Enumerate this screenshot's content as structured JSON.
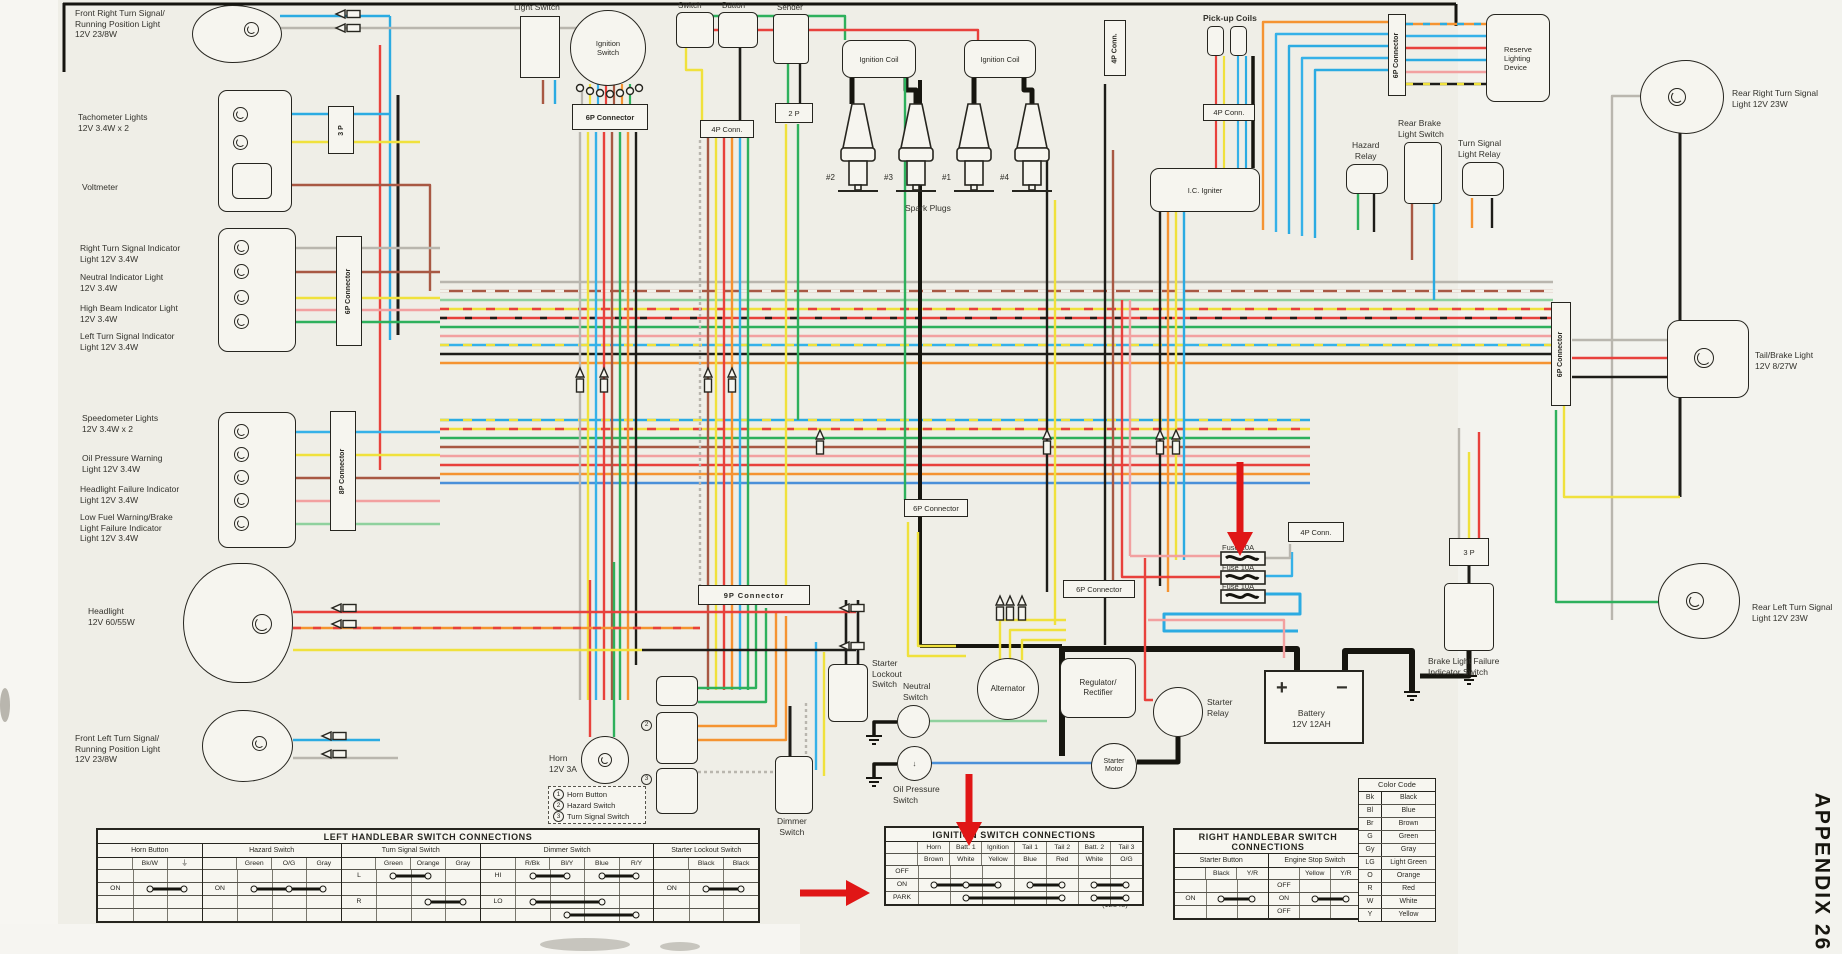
{
  "colors": {
    "red": "#e8413c",
    "blue": "#2babe2",
    "lightblue": "#35b1e8",
    "darkblue": "#4a90d9",
    "yellow": "#f0e13c",
    "green": "#2eb05c",
    "lightgreen": "#8fd19e",
    "orange": "#f59331",
    "brown": "#a85843",
    "gray": "#b9b6ae",
    "pink": "#f2a0a0",
    "black": "#1d1c18",
    "annotation": "#e01616",
    "paper": "#efeee7"
  },
  "labels": {
    "front_right_signal": "Front Right Turn Signal/\nRunning Position Light\n12V 23/8W",
    "tach": "Tachometer Lights\n12V 3.4W x 2",
    "voltmeter": "Voltmeter",
    "right_turn_ind": "Right Turn Signal Indicator\nLight 12V 3.4W",
    "neutral_ind": "Neutral Indicator Light\n12V 3.4W",
    "high_beam_ind": "High Beam Indicator Light\n12V 3.4W",
    "left_turn_ind": "Left Turn Signal Indicator\nLight 12V 3.4W",
    "speedo": "Speedometer Lights\n12V 3.4W x 2",
    "oil_warn": "Oil Pressure Warning\nLight 12V 3.4W",
    "hl_fail": "Headlight Failure Indicator\nLight 12V 3.4W",
    "low_fuel": "Low Fuel Warning/Brake\nLight Failure Indicator\nLight 12V 3.4W",
    "headlight": "Headlight\n12V 60/55W",
    "front_left_signal": "Front Left Turn Signal/\nRunning Position Light\n12V 23/8W",
    "horn": "Horn\n12V 3A",
    "light_switch": "Light Switch",
    "ignition_switch": "Ignition\nSwitch",
    "switch_top": "Switch",
    "button_top": "Button",
    "sender_top": "Sender",
    "conn_6p": "6P Connector",
    "conn_8p": "8P Connector",
    "conn_9p": "9P Connector",
    "conn_4p": "4P Conn.",
    "conn_2p": "2 P",
    "conn_3p": "3 P",
    "ignition_coil": "Ignition Coil",
    "spark_plugs": "Spark Plugs",
    "plug_2": "#2",
    "plug_3": "#3",
    "plug_1": "#1",
    "plug_4": "#4",
    "pickup_coils": "Pick-up Coils",
    "ic_igniter": "I.C. Igniter",
    "hazard_relay": "Hazard\nRelay",
    "rear_brake_switch": "Rear Brake\nLight Switch",
    "ts_relay": "Turn Signal\nLight Relay",
    "reserve": "Reserve\nLighting\nDevice",
    "rear_right_signal": "Rear Right Turn Signal\nLight 12V 23W",
    "tail_brake": "Tail/Brake Light\n12V 8/27W",
    "rear_left_signal": "Rear Left Turn Signal\nLight 12V 23W",
    "brake_fail_switch": "Brake Light Failure\nIndicator Switch",
    "fuse_20": "Fuse 20A",
    "fuse_10a": "Fuse 10A",
    "fuse_10b": "Fuse 10A",
    "starter_lockout": "Starter\nLockout\nSwitch",
    "neutral_switch": "Neutral\nSwitch",
    "oil_switch": "Oil Pressure\nSwitch",
    "alternator": "Alternator",
    "regulator": "Regulator/\nRectifier",
    "starter_relay": "Starter\nRelay",
    "starter_motor": "Starter\nMotor",
    "battery": "Battery\n12V 12AH",
    "battery_plus": "+",
    "battery_minus": "−",
    "dimmer_switch": "Dimmer\nSwitch",
    "note_2": "2",
    "note_3": "3",
    "appendix": "APPENDIX 26",
    "part_no": "(12348)"
  },
  "notes": [
    {
      "n": "1",
      "t": "Horn Button"
    },
    {
      "n": "2",
      "t": "Hazard Switch"
    },
    {
      "n": "3",
      "t": "Turn Signal Switch"
    }
  ],
  "tables": {
    "left": {
      "title": "LEFT HANDLEBAR SWITCH CONNECTIONS",
      "sections": [
        {
          "name": "Horn Button",
          "cols": [
            "Bk/W",
            "⏚"
          ],
          "rows": [
            {
              "label": ""
            },
            {
              "label": "ON",
              "conns": [
                [
                  0,
                  1
                ]
              ]
            },
            {
              "label": ""
            },
            {
              "label": ""
            }
          ]
        },
        {
          "name": "Hazard Switch",
          "cols": [
            "Green",
            "O/G",
            "Gray"
          ],
          "rows": [
            {
              "label": ""
            },
            {
              "label": "ON",
              "conns": [
                [
                  0,
                  1,
                  2
                ]
              ]
            },
            {
              "label": ""
            },
            {
              "label": ""
            }
          ]
        },
        {
          "name": "Turn Signal Switch",
          "cols": [
            "Green",
            "Orange",
            "Gray"
          ],
          "rows": [
            {
              "label": "L",
              "conns": [
                [
                  0,
                  1
                ]
              ]
            },
            {
              "label": ""
            },
            {
              "label": "R",
              "conns": [
                [
                  1,
                  2
                ]
              ]
            },
            {
              "label": ""
            }
          ]
        },
        {
          "name": "Dimmer Switch",
          "cols": [
            "R/Bk",
            "Bl/Y",
            "Blue",
            "R/Y"
          ],
          "rows": [
            {
              "label": "HI",
              "conns": [
                [
                  0,
                  1
                ],
                [
                  2,
                  3
                ]
              ]
            },
            {
              "label": ""
            },
            {
              "label": "LO",
              "conns": [
                [
                  0,
                  2
                ]
              ]
            },
            {
              "label": "",
              "conns": [
                [
                  1,
                  3
                ]
              ]
            }
          ]
        },
        {
          "name": "Starter Lockout Switch",
          "cols": [
            "Black",
            "Black"
          ],
          "rows": [
            {
              "label": ""
            },
            {
              "label": "ON",
              "conns": [
                [
                  0,
                  1
                ]
              ]
            },
            {
              "label": ""
            },
            {
              "label": ""
            }
          ]
        }
      ]
    },
    "ignition": {
      "title": "IGNITION SWITCH CONNECTIONS",
      "sections": [
        {
          "name": "",
          "cols": [
            [
              "Horn",
              "Brown"
            ],
            [
              "Batt. 1",
              "White"
            ],
            [
              "Ignition",
              "Yellow"
            ],
            [
              "Tail 1",
              "Blue"
            ],
            [
              "Tail 2",
              "Red"
            ],
            [
              "Batt. 2",
              "White"
            ],
            [
              "Tail 3",
              "O/G"
            ]
          ],
          "rows": [
            {
              "label": "OFF"
            },
            {
              "label": "ON",
              "conns": [
                [
                  0,
                  1,
                  2
                ],
                [
                  3,
                  4
                ],
                [
                  5,
                  6
                ]
              ]
            },
            {
              "label": "PARK",
              "conns": [
                [
                  1,
                  4
                ],
                [
                  5,
                  6
                ]
              ]
            }
          ]
        }
      ]
    },
    "right": {
      "title": "RIGHT HANDLEBAR SWITCH CONNECTIONS",
      "sections": [
        {
          "name": "Starter Button",
          "cols": [
            "Black",
            "Y/R"
          ],
          "rows": [
            {
              "label": ""
            },
            {
              "label": "ON",
              "conns": [
                [
                  0,
                  1
                ]
              ]
            },
            {
              "label": ""
            }
          ]
        },
        {
          "name": "Engine Stop Switch",
          "cols": [
            "Yellow",
            "Y/R"
          ],
          "rows": [
            {
              "label": "OFF"
            },
            {
              "label": "ON",
              "conns": [
                [
                  0,
                  1
                ]
              ]
            },
            {
              "label": "OFF"
            }
          ]
        }
      ]
    },
    "color_code": {
      "title": "Color Code",
      "rows": [
        [
          "Bk",
          "Black"
        ],
        [
          "Bl",
          "Blue"
        ],
        [
          "Br",
          "Brown"
        ],
        [
          "G",
          "Green"
        ],
        [
          "Gy",
          "Gray"
        ],
        [
          "LG",
          "Light Green"
        ],
        [
          "O",
          "Orange"
        ],
        [
          "R",
          "Red"
        ],
        [
          "W",
          "White"
        ],
        [
          "Y",
          "Yellow"
        ]
      ]
    }
  }
}
